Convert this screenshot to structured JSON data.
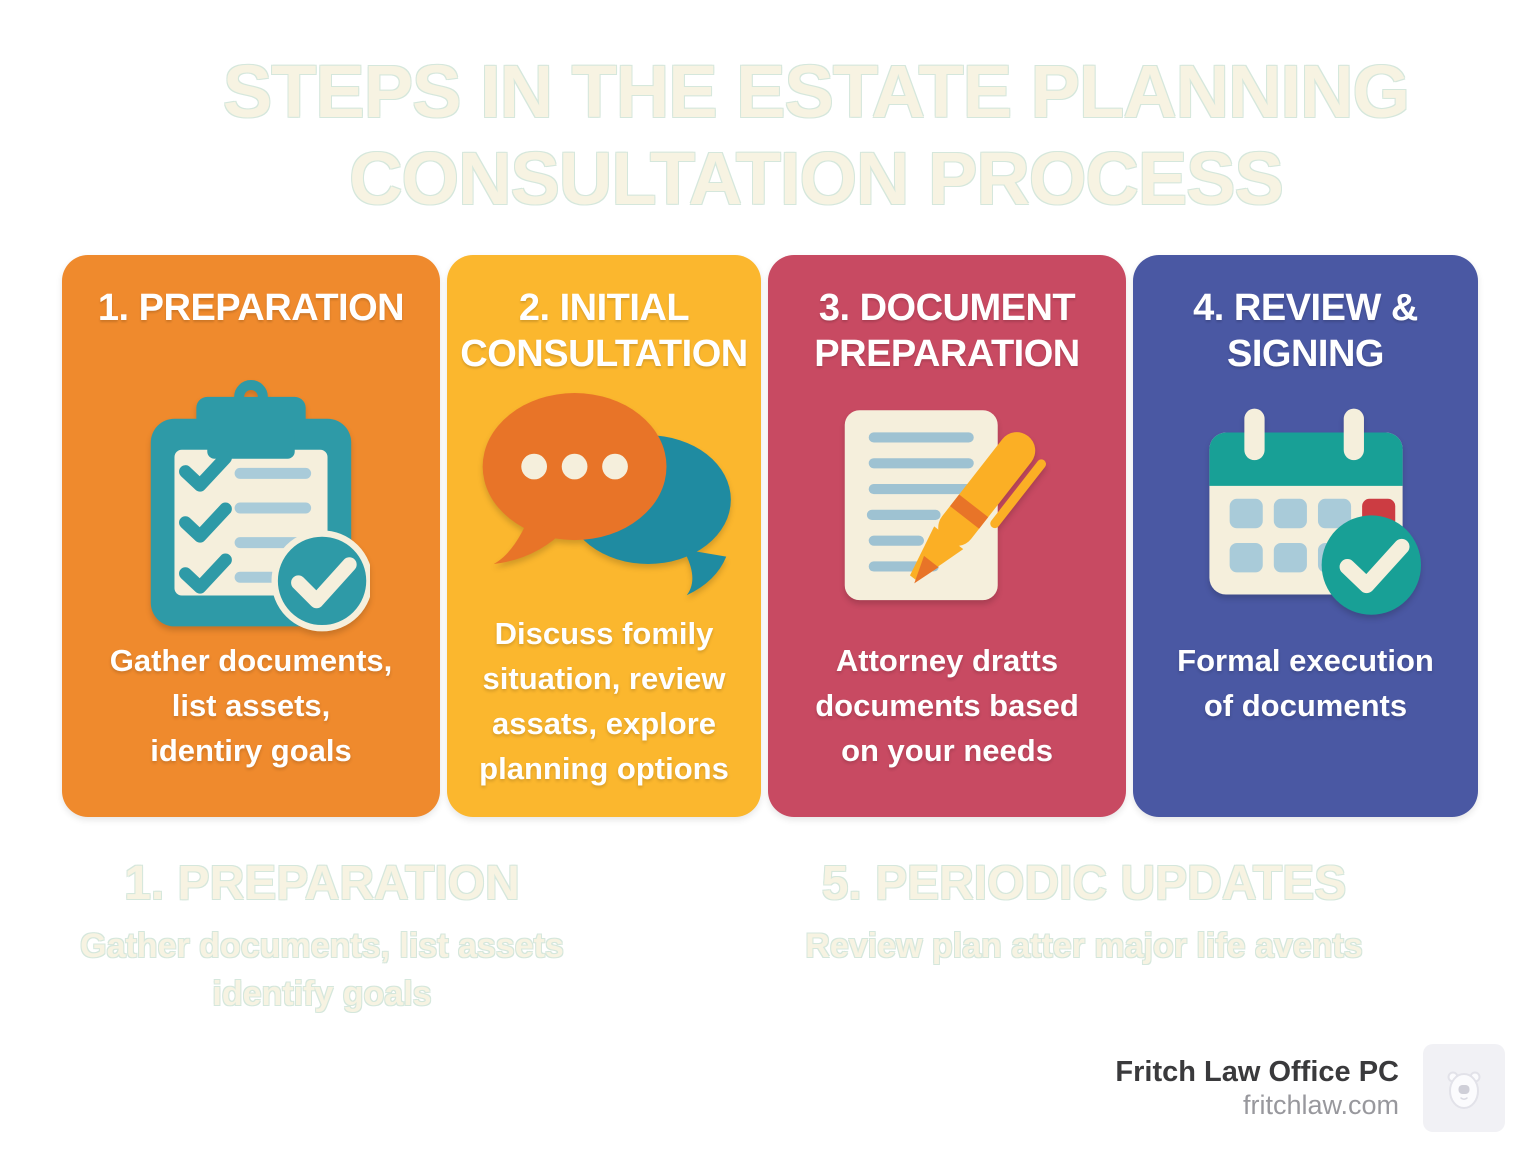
{
  "title": {
    "text": "STEPS IN THE ESTATE PLANNING\nCONSULTATION PROCESS"
  },
  "cards": [
    {
      "title": "1. PREPARATION",
      "description": "Gather documents,\nlist assets,\nidentiry goals",
      "bg": "#EF8A2D",
      "icon": "clipboard-checklist-icon"
    },
    {
      "title": "2. INITIAL\nCONSULTATION",
      "description": "Discuss fomily\nsituation, review\nassats, explore\nplanning options",
      "bg": "#FBB72E",
      "icon": "chat-bubbles-icon"
    },
    {
      "title": "3. DOCUMENT\nPREPARATION",
      "description": "Attorney dratts\ndocuments based\non your needs",
      "bg": "#C84A62",
      "icon": "document-pen-icon"
    },
    {
      "title": "4. REVIEW &\nSIGNING",
      "description": "Formal execution\nof documents",
      "bg": "#4A58A3",
      "icon": "calendar-check-icon"
    }
  ],
  "ghost_sections": [
    {
      "heading": "1. PREPARATION",
      "body": "Gather documents, list assets\nidentify goals"
    },
    {
      "heading": "5. PERIODIC UPDATES",
      "body": "Review plan atter major life avents"
    }
  ],
  "footer": {
    "company": "Fritch Law Office PC",
    "website": "fritchlaw.com",
    "logo": "bear-icon"
  },
  "palette": {
    "card_orange": "#EF8A2D",
    "card_yellow": "#FBB72E",
    "card_crimson": "#C84A62",
    "card_blue": "#4A58A3",
    "teal": "#2E9AA7",
    "teal_green": "#18A096",
    "teal_bubble": "#1F8BA1",
    "cream": "#F5EFDC",
    "light_blue": "#A9CBD9",
    "icon_orange": "#E87428",
    "pen_yellow": "#FBAF25",
    "red_accent": "#CC3C42",
    "ghost_fill": "#F7F3E2",
    "ghost_outline": "#D5E7DC",
    "footer_text": "#3A3A3C",
    "footer_muted": "#98989D",
    "logo_tile_bg": "#F1F1F5"
  }
}
